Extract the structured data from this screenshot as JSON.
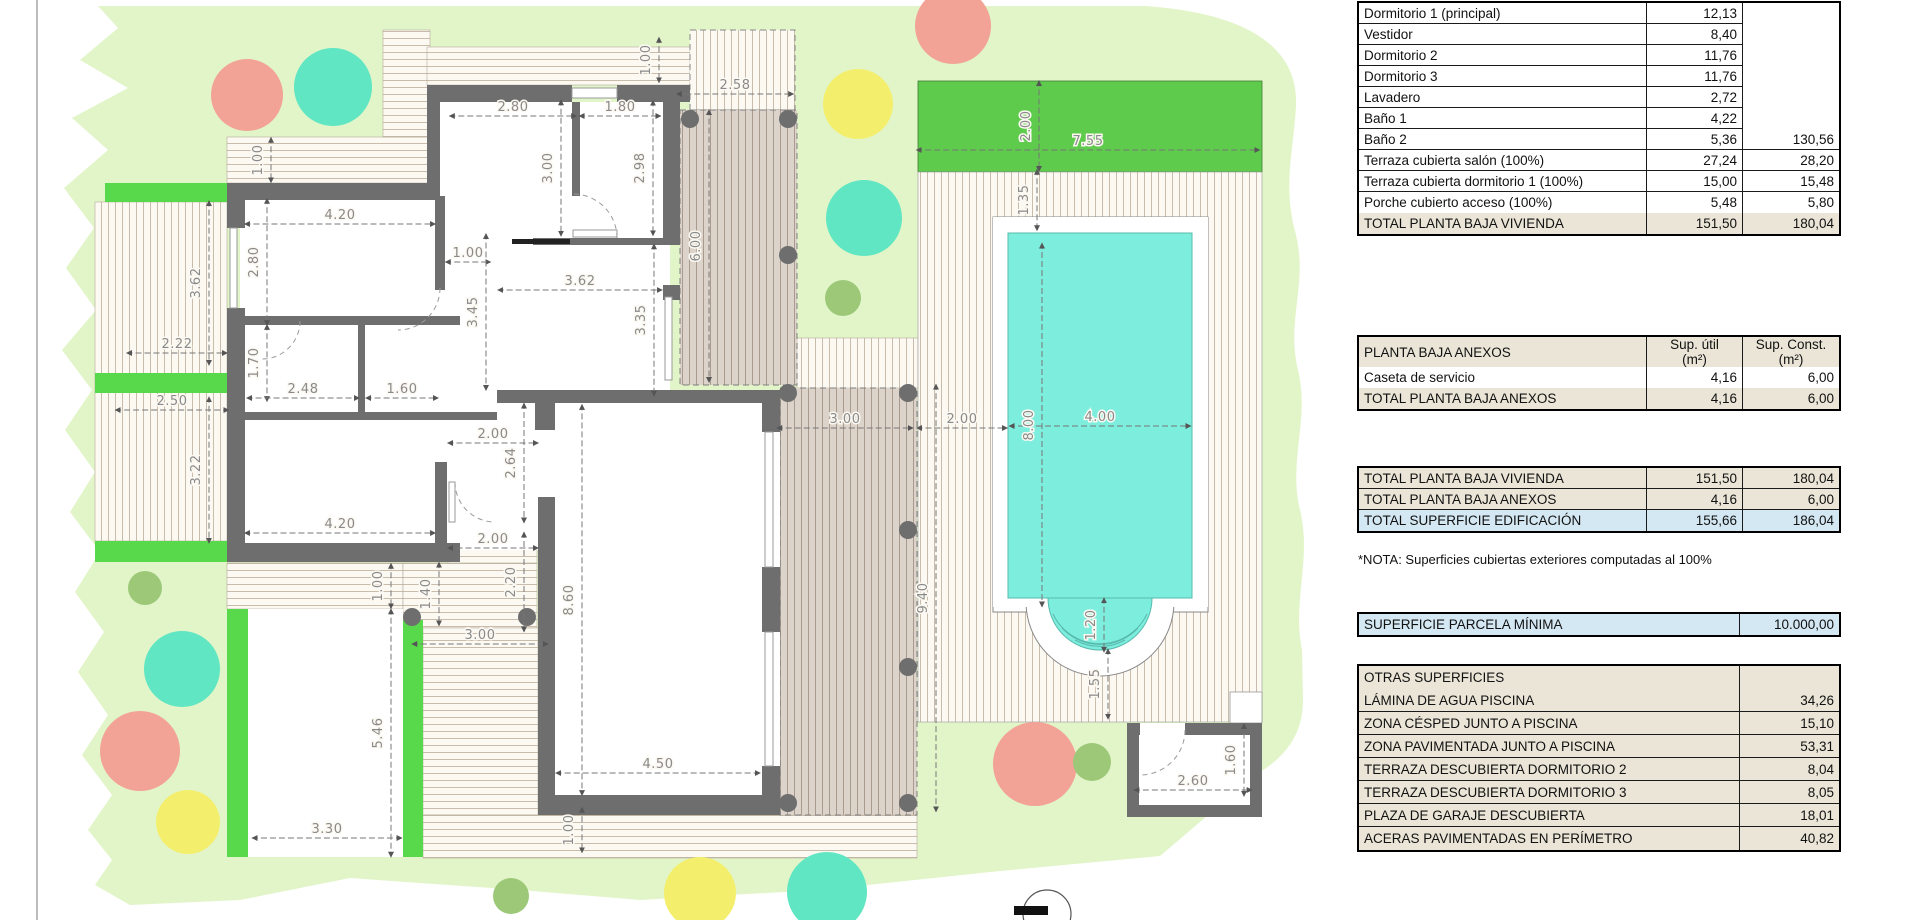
{
  "palette": {
    "garden": "#e2f5c8",
    "grass_dark": "#5ecb4c",
    "green_strip": "#58d84b",
    "pool": "#7deede",
    "salmon": "#f2a396",
    "teal": "#60e6c3",
    "yellow": "#f3ef6d",
    "olive": "#9cc878",
    "wall": "#6e6e6e",
    "hatch_bg": "#fcf9f2",
    "hatch_line": "#c9bcaa",
    "terrace_bg": "#dcd3ca",
    "terrace_line": "#a89a8d",
    "dim": "#8a8a8a",
    "table_beige": "#eae5d7",
    "table_blue": "#d4e8f3"
  },
  "plan": {
    "dims": [
      {
        "x": 262,
        "y": 160,
        "t": "1.00",
        "o": "v"
      },
      {
        "x": 513,
        "y": 110,
        "t": "2.80",
        "o": "h"
      },
      {
        "x": 620,
        "y": 110,
        "t": "1.80",
        "o": "h"
      },
      {
        "x": 650,
        "y": 60,
        "t": "1.00",
        "o": "v"
      },
      {
        "x": 735,
        "y": 88,
        "t": "2.58",
        "o": "h"
      },
      {
        "x": 552,
        "y": 168,
        "t": "3.00",
        "o": "v"
      },
      {
        "x": 644,
        "y": 168,
        "t": "2.98",
        "o": "v"
      },
      {
        "x": 1030,
        "y": 126,
        "t": "2.00",
        "o": "v"
      },
      {
        "x": 1088,
        "y": 144,
        "t": "7.55",
        "o": "h"
      },
      {
        "x": 1028,
        "y": 200,
        "t": "1.35",
        "o": "v"
      },
      {
        "x": 340,
        "y": 218,
        "t": "4.20",
        "o": "h"
      },
      {
        "x": 258,
        "y": 262,
        "t": "2.80",
        "o": "v"
      },
      {
        "x": 200,
        "y": 283,
        "t": "3.62",
        "o": "v"
      },
      {
        "x": 468,
        "y": 256,
        "t": "1.00",
        "o": "h"
      },
      {
        "x": 580,
        "y": 284,
        "t": "3.62",
        "o": "h"
      },
      {
        "x": 477,
        "y": 312,
        "t": "3.45",
        "o": "v"
      },
      {
        "x": 645,
        "y": 320,
        "t": "3.35",
        "o": "v"
      },
      {
        "x": 700,
        "y": 246,
        "t": "6.00",
        "o": "v"
      },
      {
        "x": 177,
        "y": 347,
        "t": "2.22",
        "o": "h"
      },
      {
        "x": 258,
        "y": 363,
        "t": "1.70",
        "o": "v"
      },
      {
        "x": 303,
        "y": 392,
        "t": "2.48",
        "o": "h"
      },
      {
        "x": 402,
        "y": 392,
        "t": "1.60",
        "o": "h"
      },
      {
        "x": 172,
        "y": 404,
        "t": "2.50",
        "o": "h"
      },
      {
        "x": 493,
        "y": 437,
        "t": "2.00",
        "o": "h"
      },
      {
        "x": 200,
        "y": 470,
        "t": "3.22",
        "o": "v"
      },
      {
        "x": 515,
        "y": 463,
        "t": "2.64",
        "o": "v"
      },
      {
        "x": 845,
        "y": 422,
        "t": "3.00",
        "o": "h"
      },
      {
        "x": 962,
        "y": 422,
        "t": "2.00",
        "o": "h"
      },
      {
        "x": 1100,
        "y": 420,
        "t": "4.00",
        "o": "h"
      },
      {
        "x": 1033,
        "y": 425,
        "t": "8.00",
        "o": "v"
      },
      {
        "x": 340,
        "y": 527,
        "t": "4.20",
        "o": "h"
      },
      {
        "x": 493,
        "y": 542,
        "t": "2.00",
        "o": "h"
      },
      {
        "x": 515,
        "y": 582,
        "t": "2.20",
        "o": "v"
      },
      {
        "x": 430,
        "y": 594,
        "t": "1.40",
        "o": "v"
      },
      {
        "x": 382,
        "y": 586,
        "t": "1.00",
        "o": "v"
      },
      {
        "x": 573,
        "y": 600,
        "t": "8.60",
        "o": "v"
      },
      {
        "x": 927,
        "y": 598,
        "t": "9.40",
        "o": "v"
      },
      {
        "x": 480,
        "y": 638,
        "t": "3.00",
        "o": "h"
      },
      {
        "x": 382,
        "y": 733,
        "t": "5.46",
        "o": "v"
      },
      {
        "x": 658,
        "y": 767,
        "t": "4.50",
        "o": "h"
      },
      {
        "x": 327,
        "y": 832,
        "t": "3.30",
        "o": "h"
      },
      {
        "x": 573,
        "y": 830,
        "t": "1.00",
        "o": "v"
      },
      {
        "x": 1095,
        "y": 625,
        "t": "1.20",
        "o": "v"
      },
      {
        "x": 1099,
        "y": 684,
        "t": "1.55",
        "o": "v"
      },
      {
        "x": 1193,
        "y": 784,
        "t": "2.60",
        "o": "h"
      },
      {
        "x": 1235,
        "y": 760,
        "t": "1.60",
        "o": "v"
      }
    ],
    "scale_px_per_m": 45.5,
    "trees": [
      {
        "x": 247,
        "y": 95,
        "r": 36,
        "c": "salmon"
      },
      {
        "x": 333,
        "y": 87,
        "r": 39,
        "c": "teal"
      },
      {
        "x": 953,
        "y": 26,
        "r": 38,
        "c": "salmon"
      },
      {
        "x": 858,
        "y": 104,
        "r": 35,
        "c": "yellow"
      },
      {
        "x": 864,
        "y": 218,
        "r": 38,
        "c": "teal"
      },
      {
        "x": 843,
        "y": 298,
        "r": 18,
        "c": "olive"
      },
      {
        "x": 145,
        "y": 588,
        "r": 17,
        "c": "olive"
      },
      {
        "x": 182,
        "y": 669,
        "r": 38,
        "c": "teal"
      },
      {
        "x": 140,
        "y": 751,
        "r": 40,
        "c": "salmon"
      },
      {
        "x": 188,
        "y": 822,
        "r": 32,
        "c": "yellow"
      },
      {
        "x": 511,
        "y": 896,
        "r": 18,
        "c": "olive"
      },
      {
        "x": 700,
        "y": 893,
        "r": 36,
        "c": "yellow"
      },
      {
        "x": 827,
        "y": 892,
        "r": 40,
        "c": "teal"
      },
      {
        "x": 1035,
        "y": 764,
        "r": 42,
        "c": "salmon"
      },
      {
        "x": 1092,
        "y": 762,
        "r": 19,
        "c": "olive"
      }
    ],
    "columns": [
      [
        690,
        119
      ],
      [
        788,
        119
      ],
      [
        788,
        255
      ],
      [
        788,
        393
      ],
      [
        908,
        393
      ],
      [
        908,
        530
      ],
      [
        908,
        667
      ],
      [
        908,
        803
      ],
      [
        788,
        803
      ],
      [
        412,
        617
      ],
      [
        527,
        617
      ]
    ]
  },
  "tables": {
    "vivienda": {
      "rows": [
        {
          "label": "Dormitorio 1 (principal)",
          "util": "12,13",
          "const": "",
          "cc": "mg"
        },
        {
          "label": "Vestidor",
          "util": "8,40",
          "const": "",
          "cc": "mg"
        },
        {
          "label": "Dormitorio 2",
          "util": "11,76",
          "const": "",
          "cc": "mg"
        },
        {
          "label": "Dormitorio 3",
          "util": "11,76",
          "const": "",
          "cc": "mg"
        },
        {
          "label": "Lavadero",
          "util": "2,72",
          "const": "",
          "cc": "mg"
        },
        {
          "label": "Baño 1",
          "util": "4,22",
          "const": "",
          "cc": "mg"
        },
        {
          "label": "Baño 2",
          "util": "5,36",
          "const": "130,56",
          "cc": ""
        },
        {
          "label": "Terraza cubierta salón (100%)",
          "util": "27,24",
          "const": "28,20",
          "cc": ""
        },
        {
          "label": "Terraza cubierta dormitorio 1 (100%)",
          "util": "15,00",
          "const": "15,48",
          "cc": ""
        },
        {
          "label": "Porche cubierto acceso (100%)",
          "util": "5,48",
          "const": "5,80",
          "cc": ""
        }
      ],
      "total": {
        "label": "TOTAL PLANTA BAJA VIVIENDA",
        "util": "151,50",
        "const": "180,04"
      }
    },
    "anexos": {
      "title": "PLANTA BAJA ANEXOS",
      "col_util_1": "Sup. útil",
      "col_util_2": "(m²)",
      "col_const_1": "Sup. Const.",
      "col_const_2": "(m²)",
      "rows": [
        {
          "label": "Caseta de servicio",
          "util": "4,16",
          "const": "6,00",
          "cc": ""
        }
      ],
      "total": {
        "label": "TOTAL PLANTA BAJA ANEXOS",
        "util": "4,16",
        "const": "6,00"
      }
    },
    "totales": {
      "rows": [
        {
          "label": "TOTAL PLANTA BAJA VIVIENDA",
          "util": "151,50",
          "const": "180,04",
          "hl": "bg-b"
        },
        {
          "label": "TOTAL PLANTA BAJA ANEXOS",
          "util": "4,16",
          "const": "6,00",
          "hl": "bg-b"
        },
        {
          "label": "TOTAL SUPERFICIE EDIFICACIÓN",
          "util": "155,66",
          "const": "186,04",
          "hl": "bg-u"
        }
      ]
    },
    "nota": "*NOTA: Superficies cubiertas exteriores computadas al 100%",
    "parcela": {
      "label": "SUPERFICIE PARCELA MÍNIMA",
      "value": "10.000,00"
    },
    "otras": {
      "title": "OTRAS SUPERFICIES",
      "rows": [
        {
          "label": "LÁMINA DE AGUA PISCINA",
          "value": "34,26"
        },
        {
          "label": "ZONA CÉSPED JUNTO A PISCINA",
          "value": "15,10"
        },
        {
          "label": "ZONA PAVIMENTADA JUNTO A PISCINA",
          "value": "53,31"
        },
        {
          "label": "TERRAZA DESCUBIERTA DORMITORIO 2",
          "value": "8,04"
        },
        {
          "label": "TERRAZA DESCUBIERTA DORMITORIO 3",
          "value": "8,05"
        },
        {
          "label": "PLAZA DE GARAJE DESCUBIERTA",
          "value": "18,01"
        },
        {
          "label": "ACERAS PAVIMENTADAS EN PERÍMETRO",
          "value": "40,82"
        }
      ]
    }
  }
}
